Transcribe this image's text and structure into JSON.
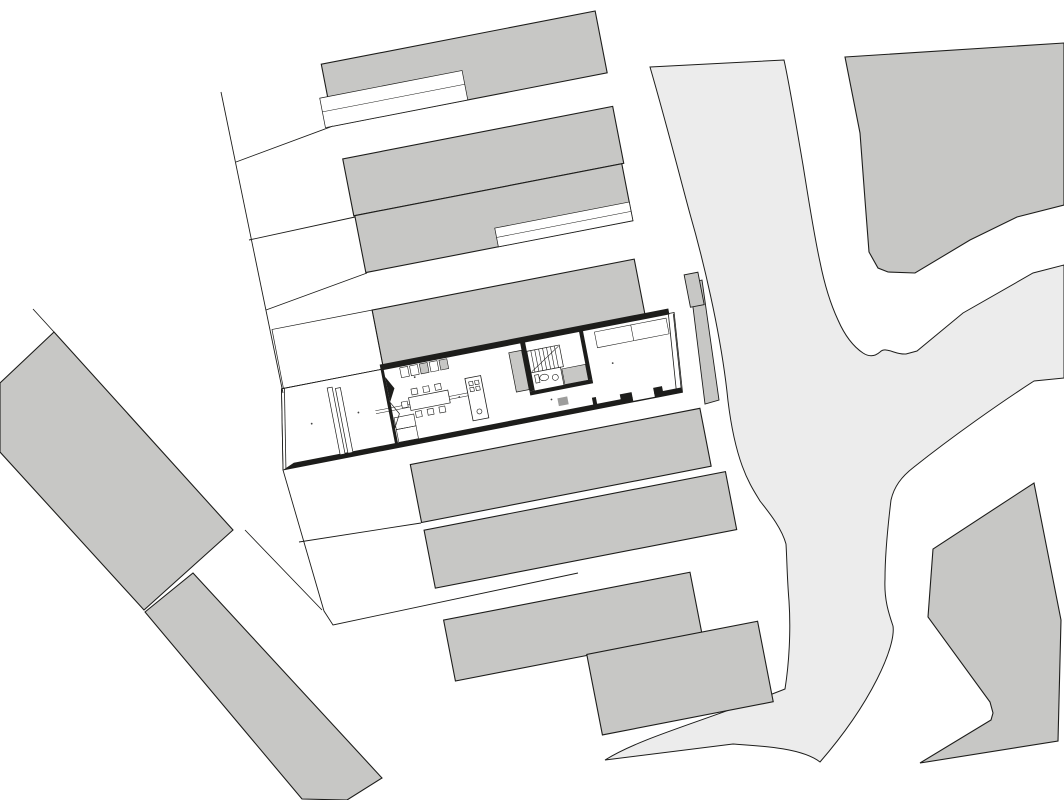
{
  "meta": {
    "type": "architectural-site-plan",
    "description": "Ground-floor site plan: detailed row-house plan embedded in urban block of parallel housing strips, curving street space at right, diagonal building slabs lower-left"
  },
  "canvas": {
    "width": 1064,
    "height": 800
  },
  "colors": {
    "white": "#ffffff",
    "ink": "#1d1d1b",
    "building": "#c7c7c5",
    "street": "#ececec",
    "fixture": "#9d9d9c",
    "dot": "#444444",
    "none": "none"
  },
  "block_rotation": {
    "angle": -11,
    "pivot_x": 283,
    "pivot_y": 470
  },
  "site_shapes": [
    {
      "name": "street-area",
      "tag": "path",
      "d": "M650,67 L784,60 C789,82 797,130 803,165 C808,196 814,235 820,262 C825,287 831,305 838,320 C845,336 854,347 863,353 Q872,359 880,352 C886,346 895,355 906,354 L917,351 L963,313 L1033,273 L1064,265 L1064,378 L1034,381 C1000,403 953,436 914,467 C901,477 894,487 891,500 C887,533 885,558 885,579 C884,600 889,614 893,626 C896,646 872,702 820,762 C802,748 762,746 733,744 L605,760 C642,737 702,722 785,689 C789,664 791,631 789,601 C787,577 787,560 786,544 C781,526 766,509 760,501 C751,486 736,466 728,401 C721,331 701,252 690,214 C681,181 666,122 650,67 Z",
      "fill": "street",
      "stroke": "ink",
      "sw": 1
    },
    {
      "name": "parcel-top-right",
      "tag": "polygon",
      "points": "845,57 1064,43 1064,205 1017,217 970,240 915,273 888,272 878,268 869,252 865,200 860,133",
      "fill": "building",
      "stroke": "ink",
      "sw": 1.1
    },
    {
      "name": "parcel-bottom-right",
      "tag": "polygon",
      "points": "1034,483 1061,620 1058,741 920,763 991,720 993,713 990,702 928,617 933,549",
      "fill": "building",
      "stroke": "ink",
      "sw": 1.1
    },
    {
      "name": "left-building-upper",
      "tag": "polygon",
      "points": "54,332 233,530 144,610 0,452 0,383",
      "fill": "building",
      "stroke": "ink",
      "sw": 1.1
    },
    {
      "name": "left-building-lower",
      "tag": "polygon",
      "points": "145,612 193,573 382,778 347,800 302,799",
      "fill": "building",
      "stroke": "ink",
      "sw": 1.1
    },
    {
      "name": "street-front-sliver",
      "tag": "polygon",
      "points": "690,283 702,280 719,400 705,404",
      "fill": "building",
      "stroke": "ink",
      "sw": 0.9
    }
  ],
  "block_shapes": [
    {
      "name": "row-north-4",
      "tag": "rect",
      "x": 398,
      "y": 79,
      "w": 279,
      "h": 63,
      "fill": "building",
      "stroke": "ink",
      "sw": 1.1
    },
    {
      "name": "row-north-4-notch",
      "tag": "rect",
      "x": 390,
      "y": 112,
      "w": 145,
      "h": 30,
      "fill": "white",
      "stroke": "ink",
      "sw": 0.7
    },
    {
      "name": "row-north-4-notch-line",
      "tag": "line",
      "x1": 390,
      "y1": 126,
      "x2": 535,
      "y2": 126,
      "stroke": "ink",
      "sw": 0.5
    },
    {
      "name": "row-north-3",
      "tag": "rect",
      "x": 401,
      "y": 176,
      "w": 275,
      "h": 58,
      "fill": "building",
      "stroke": "ink",
      "sw": 1.1
    },
    {
      "name": "row-north-2",
      "tag": "rect",
      "x": 402,
      "y": 234,
      "w": 272,
      "h": 58,
      "fill": "building",
      "stroke": "ink",
      "sw": 1.1
    },
    {
      "name": "row-north-2-notch",
      "tag": "rect",
      "x": 537,
      "y": 273,
      "w": 137,
      "h": 19,
      "fill": "white",
      "stroke": "ink",
      "sw": 0.7
    },
    {
      "name": "row-north-2-notch-line",
      "tag": "line",
      "x1": 537,
      "y1": 282.5,
      "x2": 674,
      "y2": 282.5,
      "stroke": "ink",
      "sw": 0.5
    },
    {
      "name": "row-north-1",
      "tag": "rect",
      "x": 401,
      "y": 330,
      "w": 267,
      "h": 58,
      "fill": "building",
      "stroke": "ink",
      "sw": 1.1
    },
    {
      "name": "row-north-1-corner",
      "tag": "rect",
      "x": 714,
      "y": 355,
      "w": 14,
      "h": 33,
      "fill": "building",
      "stroke": "ink",
      "sw": 0.9
    },
    {
      "name": "front-yard",
      "tag": "rect",
      "x": 299,
      "y": 330,
      "w": 102,
      "h": 60,
      "fill": "none",
      "stroke": "ink",
      "sw": 0.7
    },
    {
      "name": "row-south-1",
      "tag": "rect",
      "x": 409,
      "y": 489,
      "w": 295,
      "h": 59,
      "fill": "building",
      "stroke": "ink",
      "sw": 1.1
    },
    {
      "name": "row-south-2",
      "tag": "rect",
      "x": 410,
      "y": 556,
      "w": 307,
      "h": 59,
      "fill": "building",
      "stroke": "ink",
      "sw": 1.1
    },
    {
      "name": "row-south-3",
      "tag": "rect",
      "x": 412,
      "y": 648,
      "w": 251,
      "h": 62,
      "fill": "building",
      "stroke": "ink",
      "sw": 1.1
    },
    {
      "name": "row-south-4",
      "tag": "rect",
      "x": 546,
      "y": 709,
      "w": 174,
      "h": 82,
      "fill": "building",
      "stroke": "ink",
      "sw": 1.1
    },
    {
      "name": "house-floor",
      "tag": "polygon",
      "points": "297,390 697,390 690,470 283,470",
      "fill": "white",
      "stroke": "ink",
      "sw": 0.8
    },
    {
      "name": "house-wall-top",
      "tag": "rect",
      "x": 398,
      "y": 385,
      "w": 294,
      "h": 6,
      "fill": "ink"
    },
    {
      "name": "house-wall-bottom",
      "tag": "polygon",
      "points": "295,465 690,465 690,470 283,470",
      "fill": "ink"
    },
    {
      "name": "patio-notch",
      "tag": "rect",
      "x": 640,
      "y": 461,
      "w": 22,
      "h": 8,
      "fill": "white"
    },
    {
      "name": "patio-stub-left",
      "tag": "rect",
      "x": 628,
      "y": 460,
      "w": 12,
      "h": 6,
      "fill": "ink"
    },
    {
      "name": "patio-stub-right",
      "tag": "rect",
      "x": 662,
      "y": 460,
      "w": 9,
      "h": 6,
      "fill": "ink"
    },
    {
      "name": "house-wall-left-outer",
      "tag": "line",
      "x1": 297,
      "y1": 390,
      "x2": 283,
      "y2": 470,
      "stroke": "ink",
      "sw": 0.8
    },
    {
      "name": "house-wall-left-inner",
      "tag": "line",
      "x1": 300,
      "y1": 390,
      "x2": 286,
      "y2": 470,
      "stroke": "ink",
      "sw": 0.8
    },
    {
      "name": "house-wall-right-outer",
      "tag": "line",
      "x1": 696,
      "y1": 391,
      "x2": 689,
      "y2": 470,
      "stroke": "ink",
      "sw": 0.8
    },
    {
      "name": "house-wall-right-inner",
      "tag": "line",
      "x1": 691,
      "y1": 391,
      "x2": 684,
      "y2": 470,
      "stroke": "ink",
      "sw": 0.8
    },
    {
      "name": "house-wall-top-thin",
      "tag": "line",
      "x1": 297,
      "y1": 390,
      "x2": 398,
      "y2": 390,
      "stroke": "ink",
      "sw": 0.8
    },
    {
      "name": "entry-partition",
      "tag": "rect",
      "x": 398,
      "y": 390,
      "w": 3,
      "h": 76,
      "fill": "ink"
    },
    {
      "name": "entry-marker-solid",
      "tag": "polygon",
      "points": "401,398 408,411 401,424",
      "fill": "ink"
    },
    {
      "name": "entry-marker-open",
      "tag": "polygon",
      "points": "401,424 408,437 401,450",
      "fill": "white",
      "stroke": "ink",
      "sw": 0.7
    },
    {
      "name": "garage-rack-1",
      "tag": "rect",
      "x": 342,
      "y": 398,
      "w": 5,
      "h": 68,
      "fill": "white",
      "stroke": "ink",
      "sw": 0.7
    },
    {
      "name": "garage-rack-2",
      "tag": "rect",
      "x": 350,
      "y": 400,
      "w": 5,
      "h": 66,
      "fill": "white",
      "stroke": "ink",
      "sw": 0.7
    },
    {
      "name": "entry-closet-1",
      "tag": "rect",
      "x": 402,
      "y": 440,
      "w": 20,
      "h": 12,
      "fill": "none",
      "stroke": "ink",
      "sw": 0.6
    },
    {
      "name": "entry-closet-2",
      "tag": "rect",
      "x": 402,
      "y": 452,
      "w": 20,
      "h": 13,
      "fill": "none",
      "stroke": "ink",
      "sw": 0.6
    },
    {
      "name": "kitchen-counter-1",
      "tag": "rect",
      "x": 417,
      "y": 392,
      "w": 8,
      "h": 10,
      "fill": "white",
      "stroke": "ink",
      "sw": 0.6
    },
    {
      "name": "kitchen-counter-2",
      "tag": "rect",
      "x": 427,
      "y": 392,
      "w": 8,
      "h": 10,
      "fill": "white",
      "stroke": "ink",
      "sw": 0.6
    },
    {
      "name": "kitchen-counter-3",
      "tag": "rect",
      "x": 437,
      "y": 392,
      "w": 8,
      "h": 10,
      "fill": "building",
      "stroke": "ink",
      "sw": 0.6
    },
    {
      "name": "kitchen-counter-4",
      "tag": "rect",
      "x": 447,
      "y": 392,
      "w": 8,
      "h": 10,
      "fill": "white",
      "stroke": "ink",
      "sw": 0.6
    },
    {
      "name": "kitchen-counter-5",
      "tag": "rect",
      "x": 457,
      "y": 392,
      "w": 8,
      "h": 10,
      "fill": "building",
      "stroke": "ink",
      "sw": 0.6
    },
    {
      "name": "floor-seam-1",
      "tag": "line",
      "x1": 385,
      "y1": 429.5,
      "x2": 479,
      "y2": 429.5,
      "stroke": "ink",
      "sw": 0.5
    },
    {
      "name": "floor-seam-2",
      "tag": "line",
      "x1": 385,
      "y1": 432.5,
      "x2": 479,
      "y2": 432.5,
      "stroke": "ink",
      "sw": 0.5
    },
    {
      "name": "dining-table",
      "tag": "rect",
      "x": 420,
      "y": 423,
      "w": 40,
      "h": 13,
      "fill": "white",
      "stroke": "ink",
      "sw": 0.7
    },
    {
      "name": "chair-1",
      "tag": "rect",
      "x": 424,
      "y": 415,
      "w": 6,
      "h": 6,
      "fill": "white",
      "stroke": "ink",
      "sw": 0.6
    },
    {
      "name": "chair-2",
      "tag": "rect",
      "x": 436,
      "y": 415,
      "w": 6,
      "h": 6,
      "fill": "white",
      "stroke": "ink",
      "sw": 0.6
    },
    {
      "name": "chair-3",
      "tag": "rect",
      "x": 448,
      "y": 415,
      "w": 6,
      "h": 6,
      "fill": "white",
      "stroke": "ink",
      "sw": 0.6
    },
    {
      "name": "chair-4",
      "tag": "rect",
      "x": 424,
      "y": 438,
      "w": 6,
      "h": 6,
      "fill": "white",
      "stroke": "ink",
      "sw": 0.6
    },
    {
      "name": "chair-5",
      "tag": "rect",
      "x": 436,
      "y": 438,
      "w": 6,
      "h": 6,
      "fill": "white",
      "stroke": "ink",
      "sw": 0.6
    },
    {
      "name": "chair-6",
      "tag": "rect",
      "x": 448,
      "y": 438,
      "w": 6,
      "h": 6,
      "fill": "white",
      "stroke": "ink",
      "sw": 0.6
    },
    {
      "name": "chair-7",
      "tag": "rect",
      "x": 412,
      "y": 426,
      "w": 6,
      "h": 6,
      "fill": "white",
      "stroke": "ink",
      "sw": 0.6
    },
    {
      "name": "kitchen-island",
      "tag": "rect",
      "x": 479,
      "y": 415,
      "w": 16,
      "h": 43,
      "fill": "white",
      "stroke": "ink",
      "sw": 0.8
    },
    {
      "name": "burner-1",
      "tag": "rect",
      "x": 482,
      "y": 419,
      "w": 4,
      "h": 4,
      "fill": "none",
      "stroke": "ink",
      "sw": 0.6
    },
    {
      "name": "burner-2",
      "tag": "rect",
      "x": 488,
      "y": 419,
      "w": 4,
      "h": 4,
      "fill": "none",
      "stroke": "ink",
      "sw": 0.6
    },
    {
      "name": "burner-3",
      "tag": "rect",
      "x": 482,
      "y": 425,
      "w": 4,
      "h": 4,
      "fill": "none",
      "stroke": "ink",
      "sw": 0.6
    },
    {
      "name": "burner-4",
      "tag": "rect",
      "x": 488,
      "y": 425,
      "w": 4,
      "h": 4,
      "fill": "none",
      "stroke": "ink",
      "sw": 0.6
    },
    {
      "name": "island-sink",
      "tag": "circle",
      "cx": 487,
      "cy": 450,
      "r": 2.5,
      "fill": "none",
      "stroke": "ink",
      "sw": 0.6
    },
    {
      "name": "duct-block",
      "tag": "rect",
      "x": 527,
      "y": 398,
      "w": 13,
      "h": 40,
      "fill": "building",
      "stroke": "ink",
      "sw": 0.7
    },
    {
      "name": "stair-wall",
      "tag": "rect",
      "x": 540,
      "y": 390,
      "w": 5,
      "h": 50,
      "fill": "ink"
    },
    {
      "name": "staircase",
      "tag": "rect",
      "x": 545,
      "y": 400,
      "w": 33,
      "h": 22,
      "fill": "white",
      "stroke": "ink",
      "sw": 0.7
    },
    {
      "name": "stair-tread-1",
      "tag": "line",
      "x1": 549,
      "y1": 400,
      "x2": 549,
      "y2": 422,
      "stroke": "ink",
      "sw": 0.6
    },
    {
      "name": "stair-tread-2",
      "tag": "line",
      "x1": 553,
      "y1": 400,
      "x2": 553,
      "y2": 422,
      "stroke": "ink",
      "sw": 0.6
    },
    {
      "name": "stair-tread-3",
      "tag": "line",
      "x1": 557,
      "y1": 400,
      "x2": 557,
      "y2": 422,
      "stroke": "ink",
      "sw": 0.6
    },
    {
      "name": "stair-tread-4",
      "tag": "line",
      "x1": 561,
      "y1": 400,
      "x2": 561,
      "y2": 422,
      "stroke": "ink",
      "sw": 0.6
    },
    {
      "name": "stair-tread-5",
      "tag": "line",
      "x1": 565,
      "y1": 400,
      "x2": 565,
      "y2": 422,
      "stroke": "ink",
      "sw": 0.6
    },
    {
      "name": "stair-tread-6",
      "tag": "line",
      "x1": 569,
      "y1": 400,
      "x2": 569,
      "y2": 422,
      "stroke": "ink",
      "sw": 0.6
    },
    {
      "name": "stair-tread-7",
      "tag": "line",
      "x1": 573,
      "y1": 400,
      "x2": 573,
      "y2": 422,
      "stroke": "ink",
      "sw": 0.6
    },
    {
      "name": "stair-run-line",
      "tag": "line",
      "x1": 546,
      "y1": 421,
      "x2": 577,
      "y2": 401,
      "stroke": "ink",
      "sw": 0.6
    },
    {
      "name": "bathroom",
      "tag": "rect",
      "x": 545,
      "y": 422,
      "w": 30,
      "h": 19,
      "fill": "white",
      "stroke": "ink",
      "sw": 0.7
    },
    {
      "name": "toilet-tank",
      "tag": "rect",
      "x": 548,
      "y": 425,
      "w": 4,
      "h": 8,
      "fill": "none",
      "stroke": "ink",
      "sw": 0.6
    },
    {
      "name": "toilet-bowl",
      "tag": "ellipse",
      "cx": 557,
      "cy": 429,
      "rx": 4.5,
      "ry": 3.2,
      "fill": "none",
      "stroke": "ink",
      "sw": 0.6
    },
    {
      "name": "bath-sink",
      "tag": "circle",
      "cx": 568,
      "cy": 431,
      "r": 3,
      "fill": "none",
      "stroke": "ink",
      "sw": 0.6
    },
    {
      "name": "utility-block",
      "tag": "rect",
      "x": 576,
      "y": 424,
      "w": 24,
      "h": 16,
      "fill": "building",
      "stroke": "ink",
      "sw": 0.6
    },
    {
      "name": "corridor-wall",
      "tag": "rect",
      "x": 540,
      "y": 440,
      "w": 64,
      "h": 4,
      "fill": "ink"
    },
    {
      "name": "rear-partition-upper",
      "tag": "rect",
      "x": 600,
      "y": 390,
      "w": 4,
      "h": 50,
      "fill": "ink"
    },
    {
      "name": "rear-partition-lower",
      "tag": "rect",
      "x": 600,
      "y": 458,
      "w": 4,
      "h": 12,
      "fill": "ink"
    },
    {
      "name": "shaft-block",
      "tag": "rect",
      "x": 566,
      "y": 452,
      "w": 10,
      "h": 8,
      "fill": "fixture"
    },
    {
      "name": "rear-closet",
      "tag": "rect",
      "x": 615,
      "y": 394,
      "w": 73,
      "h": 16,
      "fill": "none",
      "stroke": "ink",
      "sw": 0.55
    },
    {
      "name": "rear-closet-divider",
      "tag": "line",
      "x1": 652,
      "y1": 394,
      "x2": 652,
      "y2": 410,
      "stroke": "ink",
      "sw": 0.55
    },
    {
      "name": "light-dot-1",
      "tag": "circle",
      "cx": 320,
      "cy": 430,
      "r": 0.9,
      "fill": "dot"
    },
    {
      "name": "light-dot-2",
      "tag": "circle",
      "cx": 368,
      "cy": 428,
      "r": 0.9,
      "fill": "dot"
    },
    {
      "name": "light-dot-3",
      "tag": "circle",
      "cx": 430,
      "cy": 404,
      "r": 0.9,
      "fill": "dot"
    },
    {
      "name": "light-dot-4",
      "tag": "circle",
      "cx": 470,
      "cy": 432,
      "r": 0.9,
      "fill": "dot"
    },
    {
      "name": "light-dot-5",
      "tag": "circle",
      "cx": 627,
      "cy": 428,
      "r": 0.9,
      "fill": "dot"
    },
    {
      "name": "light-dot-6",
      "tag": "circle",
      "cx": 560,
      "cy": 452,
      "r": 0.9,
      "fill": "dot"
    }
  ],
  "boundary_lines": [
    {
      "name": "plot-line-upper-left",
      "points": "221,92 283,393"
    },
    {
      "name": "plot-line-lower",
      "points": "283,470 324,611 333,625 578,573"
    },
    {
      "name": "plot-line-converging",
      "points": "245,530 322,610"
    },
    {
      "name": "plot-line-south-garden",
      "points": "299,542 421,523"
    },
    {
      "name": "plot-line-apex",
      "points": "33,309 54,332"
    },
    {
      "name": "plot-line-gap-1",
      "points": "236,162 333,126"
    },
    {
      "name": "plot-line-gap-2",
      "points": "249,240 355,217"
    },
    {
      "name": "plot-line-gap-3",
      "points": "266,310 367,273"
    }
  ]
}
